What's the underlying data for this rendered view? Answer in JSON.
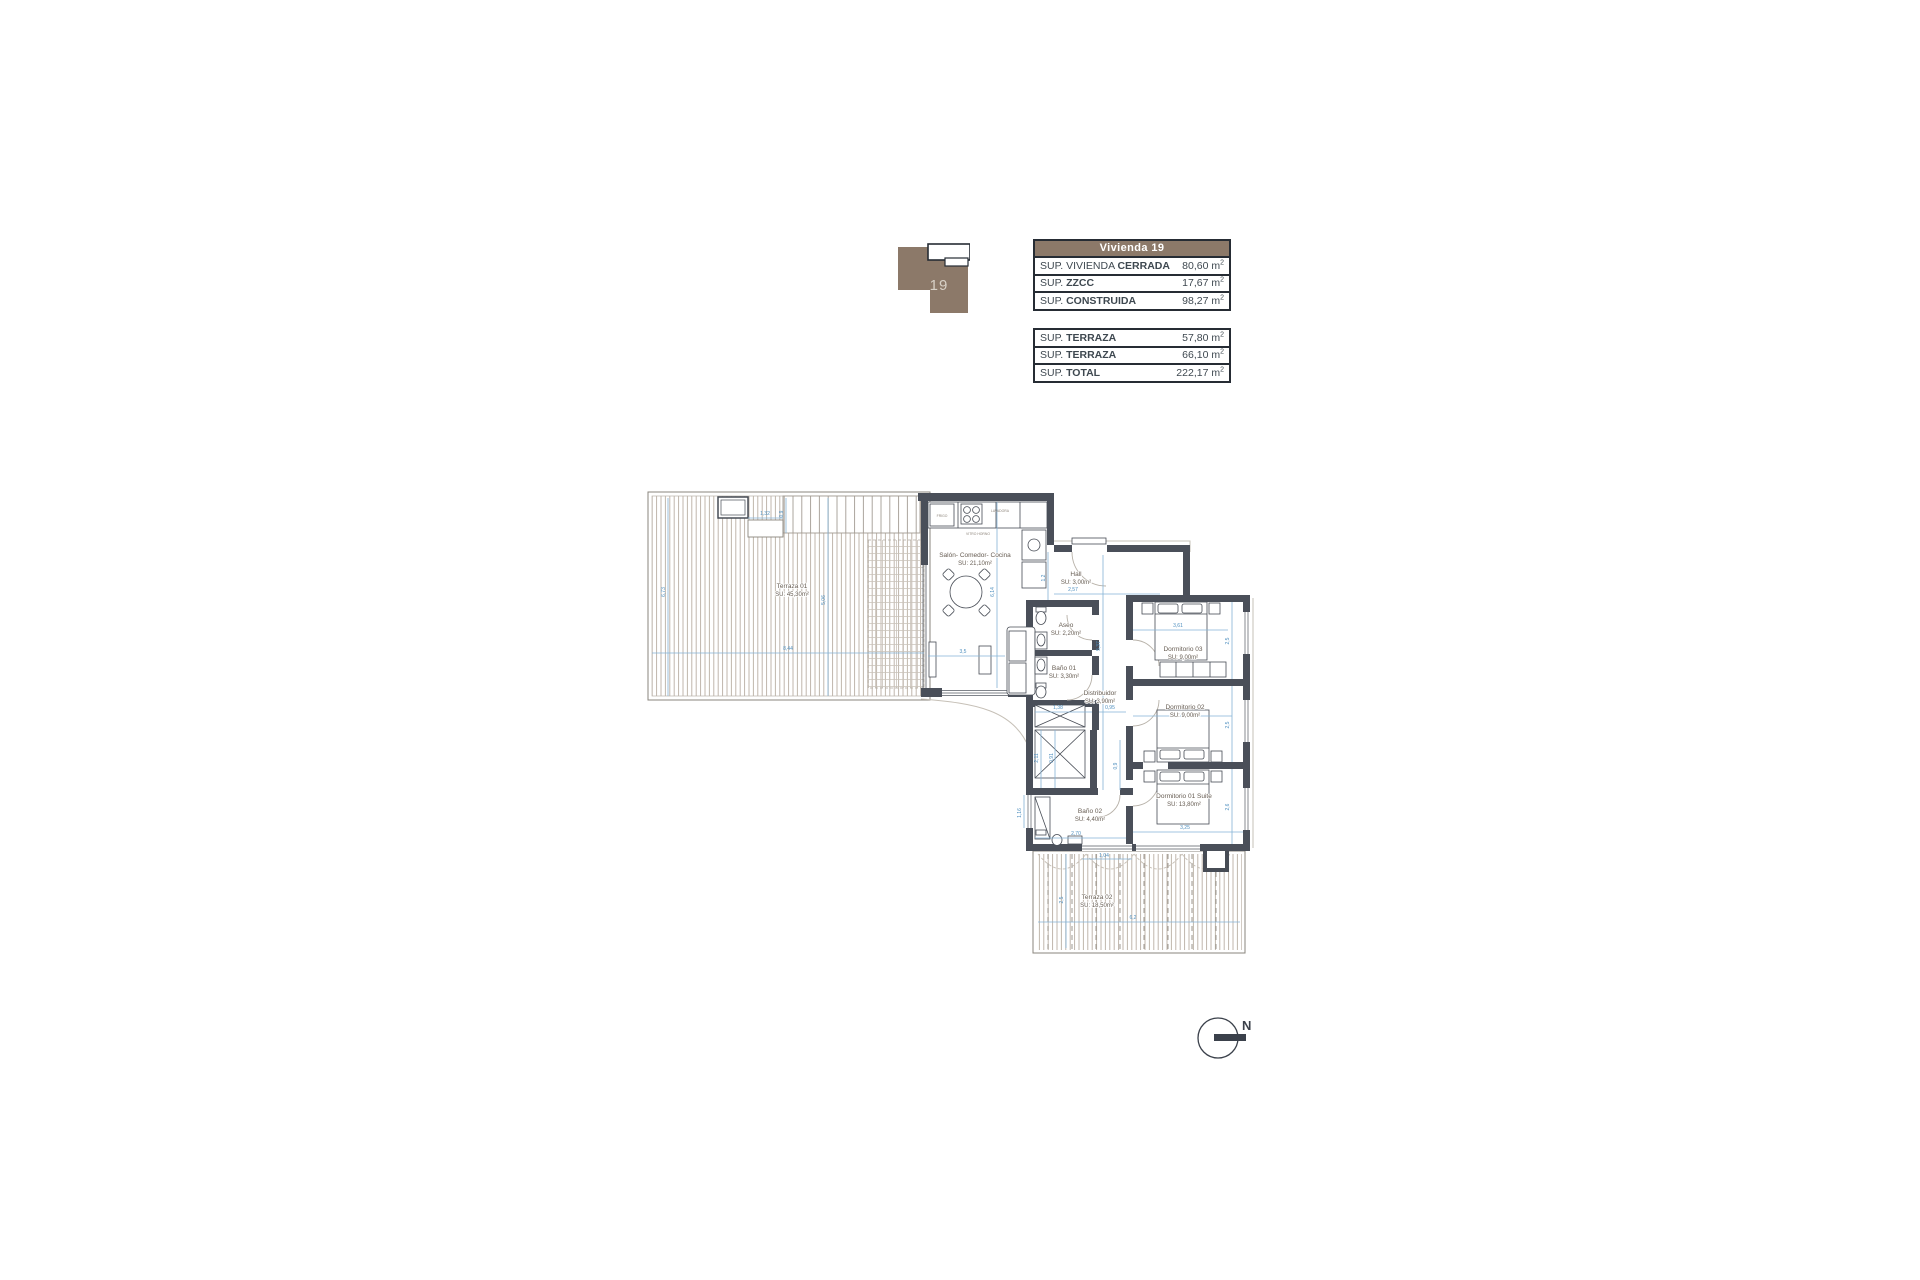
{
  "unit_badge": {
    "number": "19",
    "brand_color": "#8c7969"
  },
  "tables_shared": {
    "unit": "m",
    "sup": "2"
  },
  "summary_table": {
    "header": "Vivienda 19",
    "rows": [
      {
        "prefix": "SUP. VIVIENDA ",
        "label": "CERRADA",
        "value": "80,60"
      },
      {
        "prefix": "SUP. ",
        "label": "ZZCC",
        "value": "17,67"
      },
      {
        "prefix": "SUP. ",
        "label": "CONSTRUIDA",
        "value": "98,27"
      }
    ]
  },
  "totals_table": {
    "rows": [
      {
        "prefix": "SUP. ",
        "label": "TERRAZA",
        "value": "57,80"
      },
      {
        "prefix": "SUP. ",
        "label": "TERRAZA",
        "value": "66,10"
      },
      {
        "prefix": "SUP. ",
        "label": "TOTAL",
        "value": "222,17"
      }
    ]
  },
  "plan": {
    "rooms": {
      "salon": {
        "name": "Salón- Comedor- Cocina",
        "area": "SU: 21,10m²"
      },
      "hall": {
        "name": "Hall",
        "area": "SU: 3,00m²"
      },
      "aseo": {
        "name": "Aseo",
        "area": "SU: 2,20m²"
      },
      "bano01": {
        "name": "Baño 01",
        "area": "SU: 3,30m²"
      },
      "distribuidor": {
        "name": "Distribuidor",
        "area": "SU: 3,90m²"
      },
      "dorm03": {
        "name": "Dormitorio 03",
        "area": "SU: 9,00m²"
      },
      "dorm02": {
        "name": "Dormitorio 02",
        "area": "SU: 9,00m²"
      },
      "dorm01": {
        "name": "Dormitorio 01 Suite",
        "area": "SU: 13,80m²"
      },
      "bano02": {
        "name": "Baño 02",
        "area": "SU: 4,40m²"
      },
      "terraza01": {
        "name": "Terraza 01",
        "area": "SU: 45,30m²"
      },
      "terraza02": {
        "name": "Terraza 02",
        "area": "SU: 18,50m²"
      }
    },
    "appliances": {
      "fridge": "FRIGO",
      "hob": "VITRO HORNO",
      "washer": "LAVADORA"
    },
    "dims": {
      "terrace_w": "8,44",
      "terrace_h_left": "6,73",
      "terrace_h_mid": "5,06",
      "planter_w": "1,32",
      "planter_h": "0,9",
      "salon_h": "6,14",
      "salon_w": "3,5",
      "hall_h": "1,2",
      "hall_w": "2,57",
      "wing_h": "5,37",
      "dorm03_w": "3,61",
      "dorm03_h": "2,5",
      "dorm02_h": "2,5",
      "dorm01_w": "3,25",
      "dorm01_h": "2,6",
      "dist_a": "1,38",
      "dist_b": "0,95",
      "corr_a": "2,11",
      "corr_b": "0,91",
      "corr_c": "0,9",
      "bano02_w": "2,70",
      "bano02_h": "1,16",
      "terr2_w": "6,2",
      "terr2_h": "2,5",
      "terr2_a": "1,04"
    },
    "compass": {
      "label": "N"
    }
  }
}
